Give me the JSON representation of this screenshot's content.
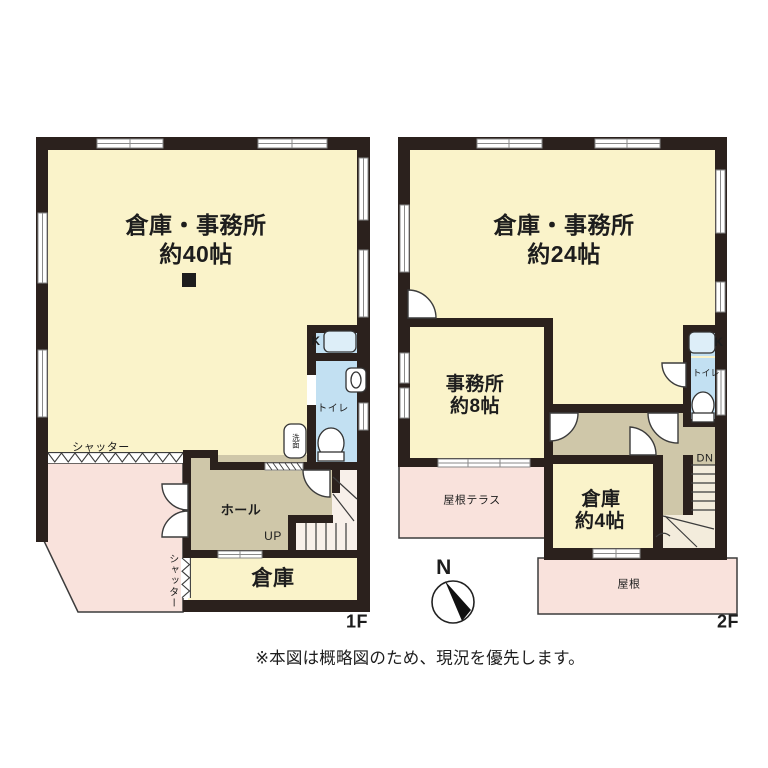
{
  "note": "※本図は概略図のため、現況を優先します。",
  "compass_label": "N",
  "colors": {
    "wall": "#2b211d",
    "room": "#faf3ca",
    "service": "#cfc7a9",
    "wet": "#c2e0f2",
    "outdoor": "#f9e2dc",
    "stair1": "#f8f0ea",
    "stair2": "#f3ecdc",
    "line": "#3c3c3c",
    "winline": "#8a8a8a",
    "fixture": "#ddeef8",
    "text": "#1d1d1d"
  },
  "floor1": {
    "label": "1F",
    "main_room": {
      "name": "倉庫・事務所",
      "area": "約40帖"
    },
    "hall": "ホール",
    "storage": "倉庫",
    "kitchen": "K",
    "toilet": "トイレ",
    "washstand": "洗面",
    "shutter_front": "シャッター",
    "shutter_side": "シャッター",
    "stair_direction": "UP"
  },
  "floor2": {
    "label": "2F",
    "main_room": {
      "name": "倉庫・事務所",
      "area": "約24帖"
    },
    "office": {
      "name": "事務所",
      "area": "約8帖"
    },
    "storage": {
      "name": "倉庫",
      "area": "約4帖"
    },
    "kitchen": "K",
    "toilet": "トイレ",
    "roof_terrace": "屋根テラス",
    "roof": "屋根",
    "stair_direction": "DN"
  }
}
